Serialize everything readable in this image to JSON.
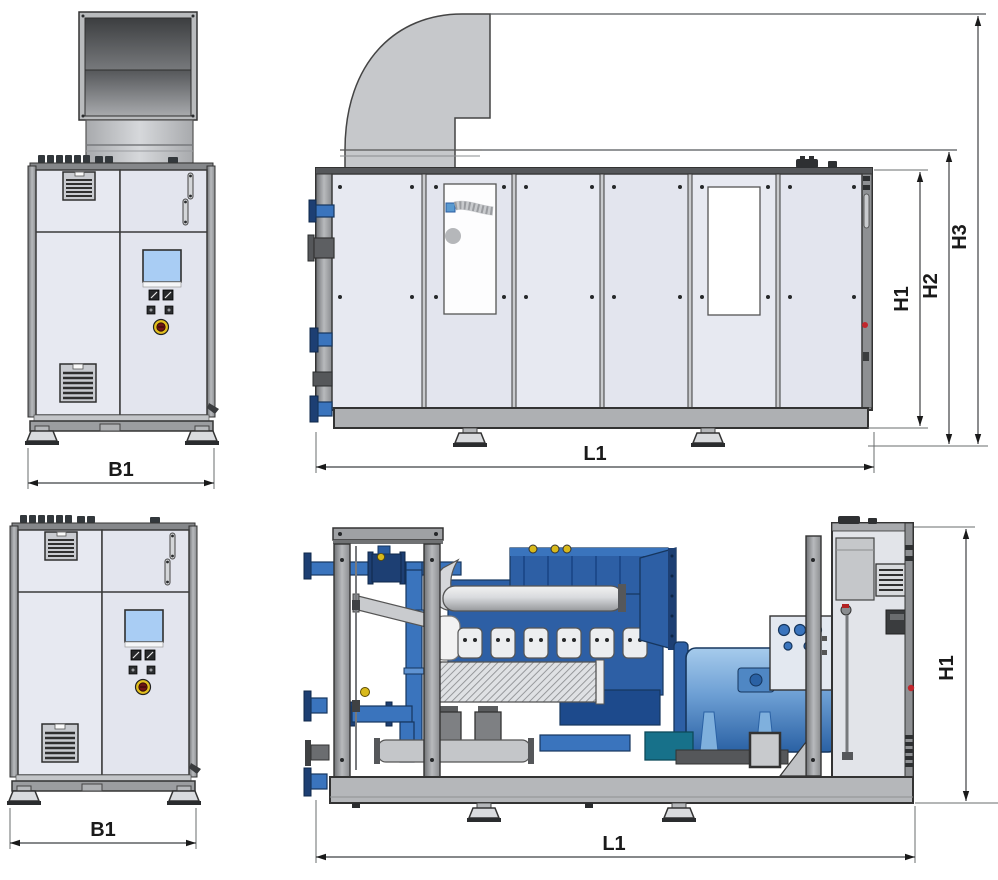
{
  "dims": {
    "b1": "B1",
    "l1": "L1",
    "h1": "H1",
    "h2": "H2",
    "h3": "H3"
  },
  "colors": {
    "panel": "#e7e9f1",
    "cabinet_trim": "#8e9093",
    "duct_body": "#c6c8cb",
    "duct_interior": "#4f5254",
    "base_frame": "#aeb0b3",
    "engine_blue": "#2d5fa5",
    "pipe_blue": "#3a74bd",
    "flange_blue": "#16365e",
    "generator_blue": "#6d9fd4",
    "exhaust_silver": "#ccced1",
    "screen_blue": "#a9cdf4",
    "estop_yellow": "#e3bf1e",
    "estop_center": "#6e1414",
    "alert_red": "#c1272d",
    "valve_yellow": "#d8b91c",
    "teal_pump": "#17718a",
    "dimension_text": "#1a1a1a"
  }
}
